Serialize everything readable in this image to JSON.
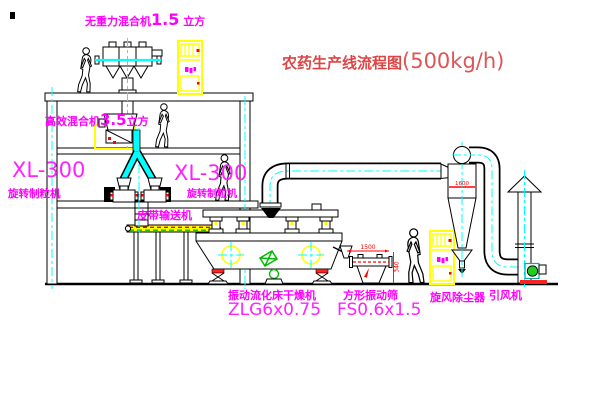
{
  "title": {
    "main": "农药生产线流程图",
    "capacity": "(500kg/h)"
  },
  "equipment": {
    "top_mixer": {
      "name": "无重力混合机",
      "size": "1.5",
      "unit": "立方"
    },
    "floor2_mixer": {
      "name": "高效混合机",
      "size": "3.5",
      "unit": "立方"
    },
    "granulator_left": {
      "model": "XL-300",
      "name": "旋转制粒机"
    },
    "granulator_mid": {
      "model": "XL-300",
      "name": "旋转制粒机"
    },
    "belt_conveyor": {
      "name": "皮带输送机"
    },
    "fluid_bed_dryer": {
      "name": "振动流化床干燥机",
      "model": "ZLG6x0.75"
    },
    "square_sieve": {
      "name": "方形振动筛",
      "model": "FS0.6x1.5"
    },
    "cyclone": {
      "name": "旋风除尘器",
      "dim": "1600"
    },
    "induced_draft_fan": {
      "name": "引风机"
    },
    "sieve_dims": {
      "length": "1500",
      "height": "340"
    }
  },
  "colors": {
    "label_magenta": "#ff00ff",
    "title_red": "#dd4444",
    "dimension_red": "#ff0000",
    "highlight_yellow": "#ffff00",
    "centerline_cyan": "#00ffff",
    "machine_green": "#00bb00"
  }
}
